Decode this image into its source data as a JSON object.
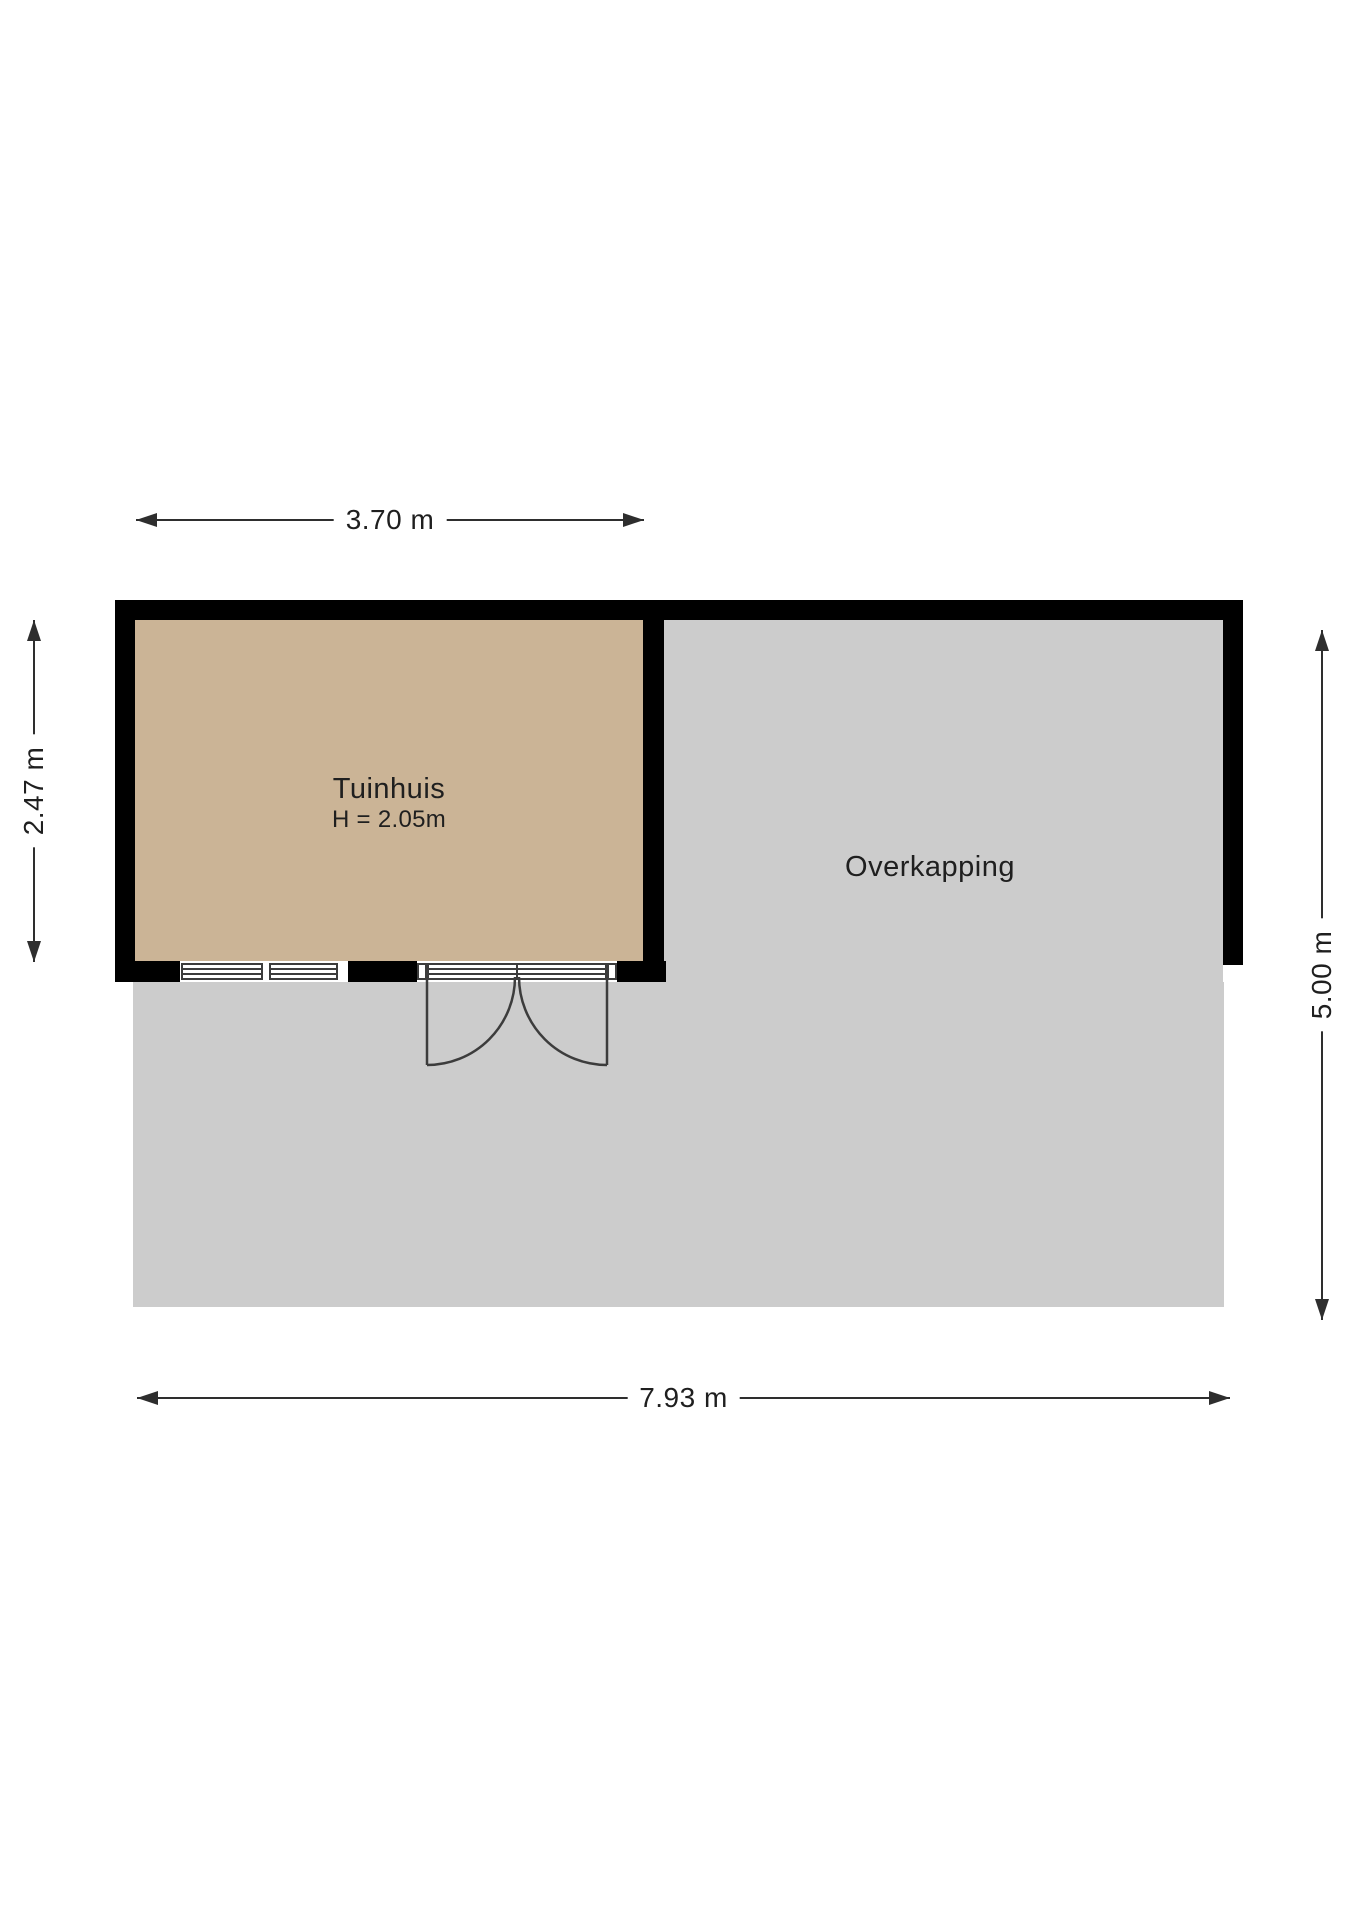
{
  "rooms": {
    "tuinhuis": {
      "label": "Tuinhuis",
      "height_label": "H = 2.05m"
    },
    "overkapping": {
      "label": "Overkapping"
    }
  },
  "dimensions": {
    "tuinhuis_width": "3.70 m",
    "tuinhuis_depth": "2.47 m",
    "total_depth": "5.00 m",
    "total_width": "7.93 m"
  },
  "colors": {
    "wall": "#000000",
    "tuinhuis_floor": "#cbb496",
    "overkapping_floor": "#cccccc",
    "frame_line": "#3c3c3c",
    "dimension": "#2e2e2e",
    "background": "#ffffff"
  }
}
